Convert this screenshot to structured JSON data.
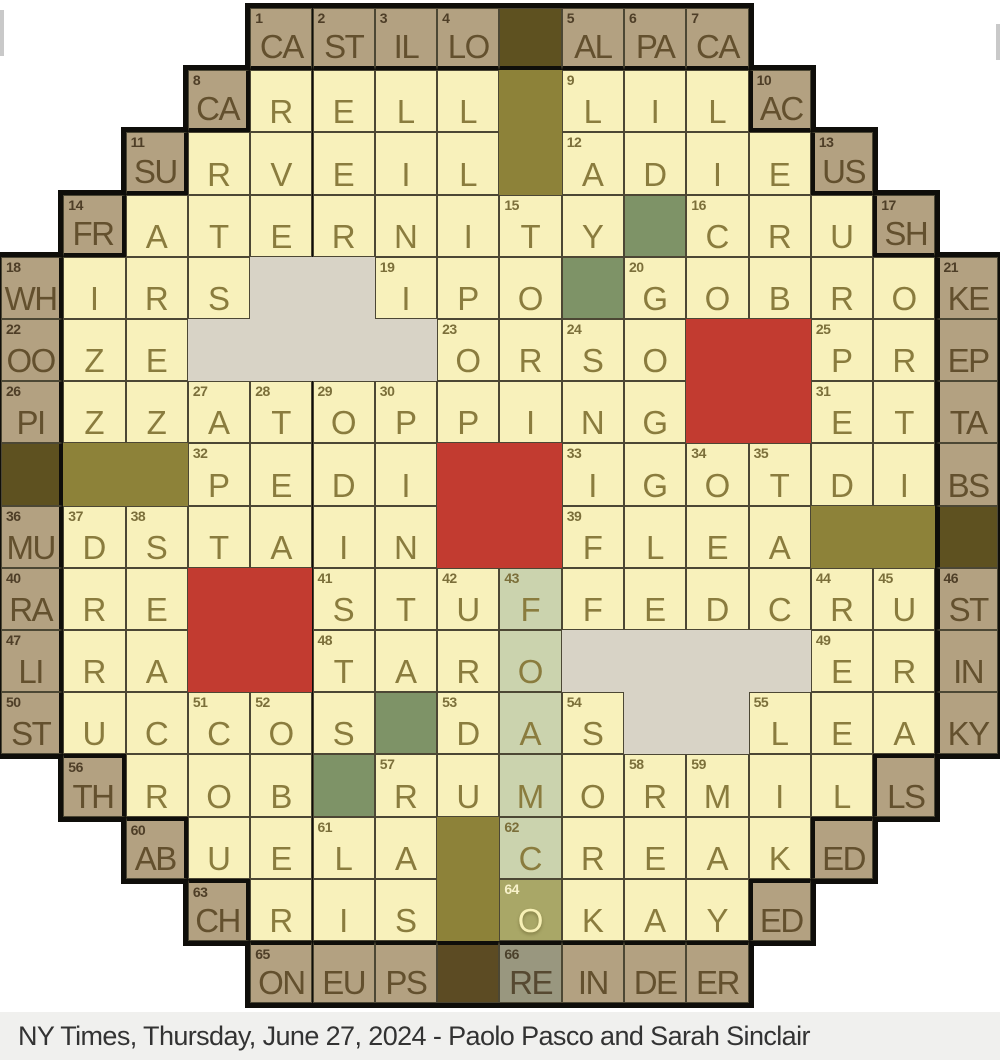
{
  "caption": {
    "text": "NY Times, Thursday, June 27, 2024 - Paolo Pasco and Sarah Sinclair"
  },
  "colors": {
    "page_bg": "#ffffff",
    "caption_bg": "#f0f0ee",
    "caption_text": "#333333",
    "cheese": "#f8f1bb",
    "crust": "#b3a181",
    "dark_block": "#5e5120",
    "dark_block_bottom": "#5c4b23",
    "olive_block": "#8d8239",
    "pepperoni_red": "#c23b30",
    "mushroom_gray": "#d8d3c6",
    "green_pepper": "#7e9367",
    "highlight_strip": "#cbd3ae",
    "highlight_cell": "#a9a767",
    "highlight_crust": "#99977f",
    "thin_line": "#4c4734",
    "thick_line": "#0f0e0a",
    "cheese_letter": "#8a7c3e",
    "crust_letter": "#63502e"
  },
  "grid": {
    "rows": 16,
    "cols": 16,
    "cw": 62.3,
    "ch": 62.2,
    "ox": 1,
    "oy": 8,
    "bw": 5,
    "tbw": 4,
    "row_spans": [
      [
        5,
        12
      ],
      [
        4,
        13
      ],
      [
        3,
        14
      ],
      [
        2,
        15
      ],
      [
        1,
        16
      ],
      [
        1,
        16
      ],
      [
        1,
        16
      ],
      [
        1,
        16
      ],
      [
        1,
        16
      ],
      [
        1,
        16
      ],
      [
        1,
        16
      ],
      [
        1,
        16
      ],
      [
        2,
        15
      ],
      [
        3,
        14
      ],
      [
        4,
        13
      ],
      [
        5,
        12
      ]
    ],
    "cell_legend": "[row, col, type(ch=cheese cr=crust dk=dark d2=dark-bottom gn=green st=strip sO=strip-selected sR=strip-crust), letter, number, thick-border-sides]",
    "cells": [
      [
        1,
        5,
        "cr",
        "CA",
        "1",
        "b"
      ],
      [
        1,
        6,
        "cr",
        "ST",
        "2",
        "b"
      ],
      [
        1,
        7,
        "cr",
        "IL",
        "3",
        "b"
      ],
      [
        1,
        8,
        "cr",
        "LO",
        "4",
        "b"
      ],
      [
        1,
        9,
        "dk",
        "",
        "",
        "b"
      ],
      [
        1,
        10,
        "cr",
        "AL",
        "5",
        "b"
      ],
      [
        1,
        11,
        "cr",
        "PA",
        "6",
        "b"
      ],
      [
        1,
        12,
        "cr",
        "CA",
        "7",
        "b"
      ],
      [
        2,
        4,
        "cr",
        "CA",
        "8",
        "rb"
      ],
      [
        2,
        5,
        "ch",
        "R",
        "",
        ""
      ],
      [
        2,
        6,
        "ch",
        "E",
        "",
        ""
      ],
      [
        2,
        7,
        "ch",
        "L",
        "",
        ""
      ],
      [
        2,
        8,
        "ch",
        "L",
        "",
        ""
      ],
      [
        2,
        10,
        "ch",
        "L",
        "9",
        ""
      ],
      [
        2,
        11,
        "ch",
        "I",
        "",
        ""
      ],
      [
        2,
        12,
        "ch",
        "L",
        "",
        ""
      ],
      [
        2,
        13,
        "cr",
        "AC",
        "10",
        "lb"
      ],
      [
        3,
        3,
        "cr",
        "SU",
        "11",
        "rb"
      ],
      [
        3,
        4,
        "ch",
        "R",
        "",
        ""
      ],
      [
        3,
        5,
        "ch",
        "V",
        "",
        ""
      ],
      [
        3,
        6,
        "ch",
        "E",
        "",
        ""
      ],
      [
        3,
        7,
        "ch",
        "I",
        "",
        ""
      ],
      [
        3,
        8,
        "ch",
        "L",
        "",
        ""
      ],
      [
        3,
        10,
        "ch",
        "A",
        "12",
        ""
      ],
      [
        3,
        11,
        "ch",
        "D",
        "",
        ""
      ],
      [
        3,
        12,
        "ch",
        "I",
        "",
        ""
      ],
      [
        3,
        13,
        "ch",
        "E",
        "",
        ""
      ],
      [
        3,
        14,
        "cr",
        "US",
        "13",
        "lb"
      ],
      [
        4,
        2,
        "cr",
        "FR",
        "14",
        "rb"
      ],
      [
        4,
        3,
        "ch",
        "A",
        "",
        ""
      ],
      [
        4,
        4,
        "ch",
        "T",
        "",
        ""
      ],
      [
        4,
        5,
        "ch",
        "E",
        "",
        ""
      ],
      [
        4,
        6,
        "ch",
        "R",
        "",
        ""
      ],
      [
        4,
        7,
        "ch",
        "N",
        "",
        ""
      ],
      [
        4,
        8,
        "ch",
        "I",
        "",
        ""
      ],
      [
        4,
        9,
        "ch",
        "T",
        "15",
        ""
      ],
      [
        4,
        10,
        "ch",
        "Y",
        "",
        ""
      ],
      [
        4,
        11,
        "gn",
        "",
        "",
        ""
      ],
      [
        4,
        12,
        "ch",
        "C",
        "16",
        ""
      ],
      [
        4,
        13,
        "ch",
        "R",
        "",
        ""
      ],
      [
        4,
        14,
        "ch",
        "U",
        "",
        ""
      ],
      [
        4,
        15,
        "cr",
        "SH",
        "17",
        "lb"
      ],
      [
        5,
        1,
        "cr",
        "WH",
        "18",
        "r"
      ],
      [
        5,
        2,
        "ch",
        "I",
        "",
        ""
      ],
      [
        5,
        3,
        "ch",
        "R",
        "",
        ""
      ],
      [
        5,
        4,
        "ch",
        "S",
        "",
        ""
      ],
      [
        5,
        7,
        "ch",
        "I",
        "19",
        ""
      ],
      [
        5,
        8,
        "ch",
        "P",
        "",
        ""
      ],
      [
        5,
        9,
        "ch",
        "O",
        "",
        ""
      ],
      [
        5,
        10,
        "gn",
        "",
        "",
        ""
      ],
      [
        5,
        11,
        "ch",
        "G",
        "20",
        ""
      ],
      [
        5,
        12,
        "ch",
        "O",
        "",
        ""
      ],
      [
        5,
        13,
        "ch",
        "B",
        "",
        ""
      ],
      [
        5,
        14,
        "ch",
        "R",
        "",
        ""
      ],
      [
        5,
        15,
        "ch",
        "O",
        "",
        ""
      ],
      [
        5,
        16,
        "cr",
        "KE",
        "21",
        "l"
      ],
      [
        6,
        1,
        "cr",
        "OO",
        "22",
        "r"
      ],
      [
        6,
        2,
        "ch",
        "Z",
        "",
        ""
      ],
      [
        6,
        3,
        "ch",
        "E",
        "",
        ""
      ],
      [
        6,
        8,
        "ch",
        "O",
        "23",
        ""
      ],
      [
        6,
        9,
        "ch",
        "R",
        "",
        ""
      ],
      [
        6,
        10,
        "ch",
        "S",
        "24",
        ""
      ],
      [
        6,
        11,
        "ch",
        "O",
        "",
        ""
      ],
      [
        6,
        14,
        "ch",
        "P",
        "25",
        ""
      ],
      [
        6,
        15,
        "ch",
        "R",
        "",
        ""
      ],
      [
        6,
        16,
        "cr",
        "EP",
        "",
        "l"
      ],
      [
        7,
        1,
        "cr",
        "PI",
        "26",
        "r"
      ],
      [
        7,
        2,
        "ch",
        "Z",
        "",
        ""
      ],
      [
        7,
        3,
        "ch",
        "Z",
        "",
        ""
      ],
      [
        7,
        4,
        "ch",
        "A",
        "27",
        ""
      ],
      [
        7,
        5,
        "ch",
        "T",
        "28",
        ""
      ],
      [
        7,
        6,
        "ch",
        "O",
        "29",
        ""
      ],
      [
        7,
        7,
        "ch",
        "P",
        "30",
        ""
      ],
      [
        7,
        8,
        "ch",
        "P",
        "",
        ""
      ],
      [
        7,
        9,
        "ch",
        "I",
        "",
        ""
      ],
      [
        7,
        10,
        "ch",
        "N",
        "",
        ""
      ],
      [
        7,
        11,
        "ch",
        "G",
        "",
        ""
      ],
      [
        7,
        14,
        "ch",
        "E",
        "31",
        ""
      ],
      [
        7,
        15,
        "ch",
        "T",
        "",
        ""
      ],
      [
        7,
        16,
        "cr",
        "TA",
        "",
        "l"
      ],
      [
        8,
        1,
        "dk",
        "",
        "",
        "r"
      ],
      [
        8,
        4,
        "ch",
        "P",
        "32",
        ""
      ],
      [
        8,
        5,
        "ch",
        "E",
        "",
        ""
      ],
      [
        8,
        6,
        "ch",
        "D",
        "",
        ""
      ],
      [
        8,
        7,
        "ch",
        "I",
        "",
        ""
      ],
      [
        8,
        10,
        "ch",
        "I",
        "33",
        ""
      ],
      [
        8,
        11,
        "ch",
        "G",
        "",
        ""
      ],
      [
        8,
        12,
        "ch",
        "O",
        "34",
        ""
      ],
      [
        8,
        13,
        "ch",
        "T",
        "35",
        ""
      ],
      [
        8,
        14,
        "ch",
        "D",
        "",
        ""
      ],
      [
        8,
        15,
        "ch",
        "I",
        "",
        ""
      ],
      [
        8,
        16,
        "cr",
        "BS",
        "",
        "l"
      ],
      [
        9,
        1,
        "cr",
        "MU",
        "36",
        "r"
      ],
      [
        9,
        2,
        "ch",
        "D",
        "37",
        ""
      ],
      [
        9,
        3,
        "ch",
        "S",
        "38",
        ""
      ],
      [
        9,
        4,
        "ch",
        "T",
        "",
        ""
      ],
      [
        9,
        5,
        "ch",
        "A",
        "",
        ""
      ],
      [
        9,
        6,
        "ch",
        "I",
        "",
        ""
      ],
      [
        9,
        7,
        "ch",
        "N",
        "",
        ""
      ],
      [
        9,
        10,
        "ch",
        "F",
        "39",
        ""
      ],
      [
        9,
        11,
        "ch",
        "L",
        "",
        ""
      ],
      [
        9,
        12,
        "ch",
        "E",
        "",
        ""
      ],
      [
        9,
        13,
        "ch",
        "A",
        "",
        ""
      ],
      [
        9,
        16,
        "dk",
        "",
        "",
        "l"
      ],
      [
        10,
        1,
        "cr",
        "RA",
        "40",
        "r"
      ],
      [
        10,
        2,
        "ch",
        "R",
        "",
        ""
      ],
      [
        10,
        3,
        "ch",
        "E",
        "",
        ""
      ],
      [
        10,
        6,
        "ch",
        "S",
        "41",
        ""
      ],
      [
        10,
        7,
        "ch",
        "T",
        "",
        ""
      ],
      [
        10,
        8,
        "ch",
        "U",
        "42",
        ""
      ],
      [
        10,
        9,
        "st",
        "F",
        "43",
        ""
      ],
      [
        10,
        10,
        "ch",
        "F",
        "",
        ""
      ],
      [
        10,
        11,
        "ch",
        "E",
        "",
        ""
      ],
      [
        10,
        12,
        "ch",
        "D",
        "",
        ""
      ],
      [
        10,
        13,
        "ch",
        "C",
        "",
        ""
      ],
      [
        10,
        14,
        "ch",
        "R",
        "44",
        ""
      ],
      [
        10,
        15,
        "ch",
        "U",
        "45",
        ""
      ],
      [
        10,
        16,
        "cr",
        "ST",
        "46",
        "l"
      ],
      [
        11,
        1,
        "cr",
        "LI",
        "47",
        "r"
      ],
      [
        11,
        2,
        "ch",
        "R",
        "",
        ""
      ],
      [
        11,
        3,
        "ch",
        "A",
        "",
        ""
      ],
      [
        11,
        6,
        "ch",
        "T",
        "48",
        ""
      ],
      [
        11,
        7,
        "ch",
        "A",
        "",
        ""
      ],
      [
        11,
        8,
        "ch",
        "R",
        "",
        ""
      ],
      [
        11,
        9,
        "st",
        "O",
        "",
        ""
      ],
      [
        11,
        14,
        "ch",
        "E",
        "49",
        ""
      ],
      [
        11,
        15,
        "ch",
        "R",
        "",
        ""
      ],
      [
        11,
        16,
        "cr",
        "IN",
        "",
        "l"
      ],
      [
        12,
        1,
        "cr",
        "ST",
        "50",
        "r"
      ],
      [
        12,
        2,
        "ch",
        "U",
        "",
        ""
      ],
      [
        12,
        3,
        "ch",
        "C",
        "",
        ""
      ],
      [
        12,
        4,
        "ch",
        "C",
        "51",
        ""
      ],
      [
        12,
        5,
        "ch",
        "O",
        "52",
        ""
      ],
      [
        12,
        6,
        "ch",
        "S",
        "",
        ""
      ],
      [
        12,
        7,
        "gn",
        "",
        "",
        ""
      ],
      [
        12,
        8,
        "ch",
        "D",
        "53",
        ""
      ],
      [
        12,
        9,
        "st",
        "A",
        "",
        ""
      ],
      [
        12,
        10,
        "ch",
        "S",
        "54",
        ""
      ],
      [
        12,
        13,
        "ch",
        "L",
        "55",
        ""
      ],
      [
        12,
        14,
        "ch",
        "E",
        "",
        ""
      ],
      [
        12,
        15,
        "ch",
        "A",
        "",
        ""
      ],
      [
        12,
        16,
        "cr",
        "KY",
        "",
        "l"
      ],
      [
        13,
        2,
        "cr",
        "TH",
        "56",
        "rt"
      ],
      [
        13,
        3,
        "ch",
        "R",
        "",
        ""
      ],
      [
        13,
        4,
        "ch",
        "O",
        "",
        ""
      ],
      [
        13,
        5,
        "ch",
        "B",
        "",
        ""
      ],
      [
        13,
        6,
        "gn",
        "",
        "",
        ""
      ],
      [
        13,
        7,
        "ch",
        "R",
        "57",
        ""
      ],
      [
        13,
        8,
        "ch",
        "U",
        "",
        ""
      ],
      [
        13,
        9,
        "st",
        "M",
        "",
        ""
      ],
      [
        13,
        10,
        "ch",
        "O",
        "",
        ""
      ],
      [
        13,
        11,
        "ch",
        "R",
        "58",
        ""
      ],
      [
        13,
        12,
        "ch",
        "M",
        "59",
        ""
      ],
      [
        13,
        13,
        "ch",
        "I",
        "",
        ""
      ],
      [
        13,
        14,
        "ch",
        "L",
        "",
        ""
      ],
      [
        13,
        15,
        "cr",
        "LS",
        "",
        "lt"
      ],
      [
        14,
        3,
        "cr",
        "AB",
        "60",
        "rt"
      ],
      [
        14,
        4,
        "ch",
        "U",
        "",
        ""
      ],
      [
        14,
        5,
        "ch",
        "E",
        "",
        ""
      ],
      [
        14,
        6,
        "ch",
        "L",
        "61",
        ""
      ],
      [
        14,
        7,
        "ch",
        "A",
        "",
        ""
      ],
      [
        14,
        9,
        "st",
        "C",
        "62",
        ""
      ],
      [
        14,
        10,
        "ch",
        "R",
        "",
        ""
      ],
      [
        14,
        11,
        "ch",
        "E",
        "",
        ""
      ],
      [
        14,
        12,
        "ch",
        "A",
        "",
        ""
      ],
      [
        14,
        13,
        "ch",
        "K",
        "",
        ""
      ],
      [
        14,
        14,
        "cr",
        "ED",
        "",
        "lt"
      ],
      [
        15,
        4,
        "cr",
        "CH",
        "63",
        "rt"
      ],
      [
        15,
        5,
        "ch",
        "R",
        "",
        ""
      ],
      [
        15,
        6,
        "ch",
        "I",
        "",
        ""
      ],
      [
        15,
        7,
        "ch",
        "S",
        "",
        ""
      ],
      [
        15,
        9,
        "sO",
        "O",
        "64",
        ""
      ],
      [
        15,
        10,
        "ch",
        "K",
        "",
        ""
      ],
      [
        15,
        11,
        "ch",
        "A",
        "",
        ""
      ],
      [
        15,
        12,
        "ch",
        "Y",
        "",
        ""
      ],
      [
        15,
        13,
        "cr",
        "ED",
        "",
        "lt"
      ],
      [
        16,
        5,
        "cr",
        "ON",
        "65",
        "t"
      ],
      [
        16,
        6,
        "cr",
        "EU",
        "",
        "t"
      ],
      [
        16,
        7,
        "cr",
        "PS",
        "",
        "t"
      ],
      [
        16,
        8,
        "d2",
        "",
        "",
        "t"
      ],
      [
        16,
        9,
        "sR",
        "RE",
        "66",
        "t"
      ],
      [
        16,
        10,
        "cr",
        "IN",
        "",
        "t"
      ],
      [
        16,
        11,
        "cr",
        "DE",
        "",
        "t"
      ],
      [
        16,
        12,
        "cr",
        "ER",
        "",
        "t"
      ]
    ],
    "toppings": [
      {
        "kind": "mushroom",
        "r": 5,
        "c": 5,
        "w": 2,
        "h": 1
      },
      {
        "kind": "mushroom",
        "r": 6,
        "c": 4,
        "w": 4,
        "h": 1
      },
      {
        "kind": "mushroom",
        "r": 11,
        "c": 10,
        "w": 4,
        "h": 1
      },
      {
        "kind": "mushroom",
        "r": 12,
        "c": 11,
        "w": 2,
        "h": 1
      },
      {
        "kind": "pepperoni",
        "r": 6,
        "c": 12,
        "w": 2,
        "h": 2
      },
      {
        "kind": "pepperoni",
        "r": 8,
        "c": 8,
        "w": 2,
        "h": 2
      },
      {
        "kind": "pepperoni",
        "r": 10,
        "c": 4,
        "w": 2,
        "h": 2
      },
      {
        "kind": "olive",
        "r": 2,
        "c": 9,
        "w": 1,
        "h": 2
      },
      {
        "kind": "olive",
        "r": 8,
        "c": 2,
        "w": 2,
        "h": 1
      },
      {
        "kind": "olive",
        "r": 9,
        "c": 14,
        "w": 2,
        "h": 1
      },
      {
        "kind": "olive",
        "r": 14,
        "c": 8,
        "w": 1,
        "h": 2
      }
    ]
  }
}
